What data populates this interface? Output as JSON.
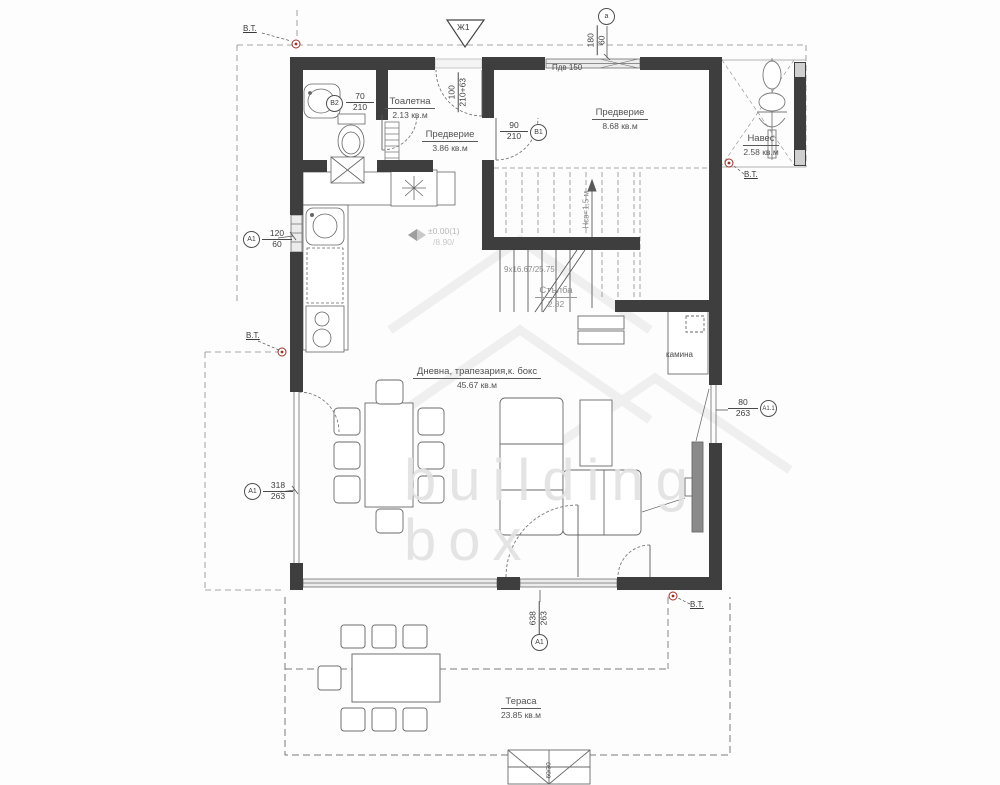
{
  "watermark": {
    "line1": "building",
    "line2": "box"
  },
  "rooms": {
    "toilet": {
      "name": "Тоалетна",
      "area": "2.13 кв.м"
    },
    "vestibule_small": {
      "name": "Предверие",
      "area": "3.86 кв.м"
    },
    "vestibule_large": {
      "name": "Предверие",
      "area": "8.68 кв.м"
    },
    "canopy": {
      "name": "Навес",
      "area": "2.58 кв.м"
    },
    "stairs": {
      "name": "Стълба",
      "area": "2.82"
    },
    "living": {
      "name": "Дневна, трапезария,к. бокс",
      "area": "45.67 кв.м"
    },
    "terrace": {
      "name": "Тераса",
      "area": "23.85 кв.м"
    }
  },
  "annotations": {
    "fireplace": "камина",
    "stair_dim": "9x16.67/25.75",
    "clear_height": "Нсв=1,5 м",
    "sill": "Пдв 150",
    "vt": "В.Т.",
    "section_marker": "Ж1",
    "axis_marker": "а",
    "elevation_level": "±0.00(1)",
    "elevation_alt": "/8.90/",
    "steps_dim": "60/30"
  },
  "openings": {
    "toilet_door": {
      "w": "70",
      "h": "210",
      "ref": "В2"
    },
    "entry_door": {
      "w": "100",
      "h": "210+63"
    },
    "hall_door": {
      "w": "90",
      "h": "210",
      "ref": "В1"
    },
    "top_window": {
      "w": "180",
      "h": "60",
      "ref": "а"
    },
    "kitchen_window": {
      "w": "120",
      "h": "60",
      "ref": "А1"
    },
    "left_window": {
      "w": "318",
      "h": "263",
      "ref": "А1"
    },
    "right_window": {
      "w": "80",
      "h": "263",
      "ref": "А1.1"
    },
    "bottom_window": {
      "w": "638",
      "h": "263",
      "ref": "А1"
    }
  },
  "colors": {
    "wall": "#3e3e3e",
    "marker_red": "#9c2f28",
    "line": "#4a4a4a",
    "watermark": "#e3e3e3"
  }
}
